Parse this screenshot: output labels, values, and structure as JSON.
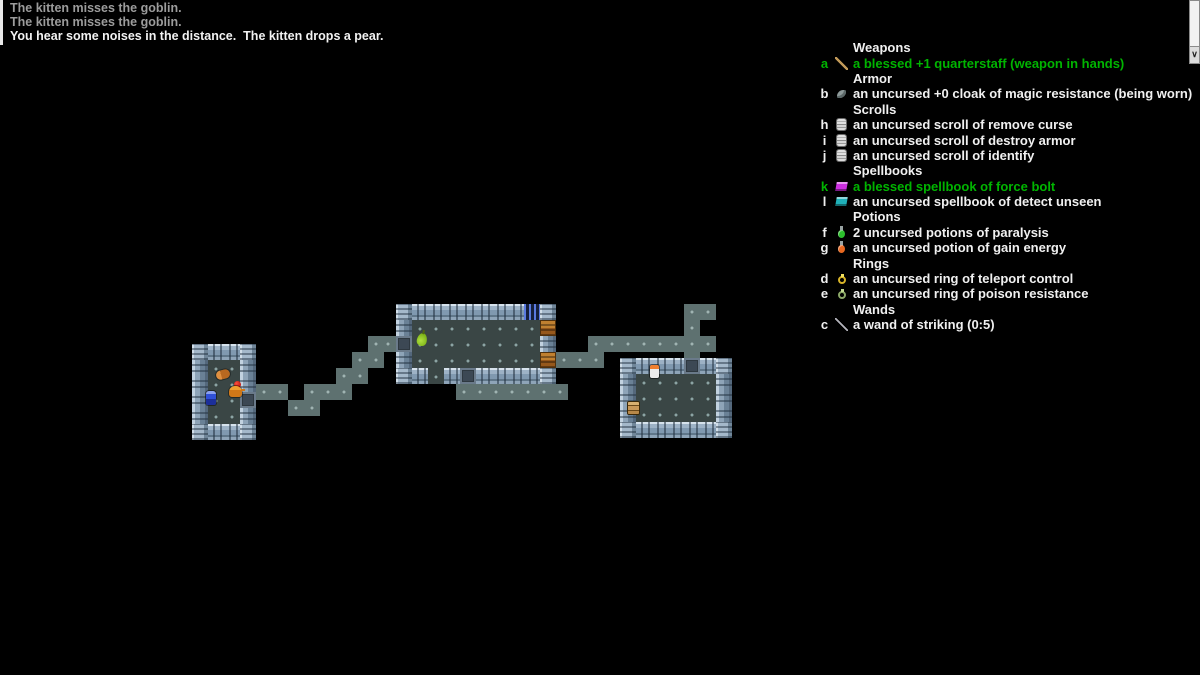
{
  "messages": [
    {
      "text": "The kitten misses the goblin.",
      "state": "old"
    },
    {
      "text": "The kitten misses the goblin.",
      "state": "old"
    },
    {
      "text": "You hear some noises in the distance.  The kitten drops a pear.",
      "state": "new"
    }
  ],
  "scrollbar": {
    "down_arrow": "∨"
  },
  "colors": {
    "blessed_green": "#00b400",
    "old_message_gray": "#9c9c9c",
    "new_message_white": "#f2f2f2",
    "floor": "#3a4645",
    "corridor": "#5e7170",
    "wall": "#9db2c6",
    "open_door_orange": "#c08030",
    "iron_bars_blue": "#5a7ae0"
  },
  "inventory": {
    "sections": [
      {
        "header": "Weapons",
        "items": [
          {
            "letter": "a",
            "icon": "quarterstaff",
            "text": "a blessed +1 quarterstaff (weapon in hands)",
            "blessed": true
          }
        ]
      },
      {
        "header": "Armor",
        "items": [
          {
            "letter": "b",
            "icon": "cloak",
            "text": "an uncursed +0 cloak of magic resistance (being worn)",
            "blessed": false
          }
        ]
      },
      {
        "header": "Scrolls",
        "items": [
          {
            "letter": "h",
            "icon": "scroll",
            "text": "an uncursed scroll of remove curse",
            "blessed": false
          },
          {
            "letter": "i",
            "icon": "scroll",
            "text": "an uncursed scroll of destroy armor",
            "blessed": false
          },
          {
            "letter": "j",
            "icon": "scroll",
            "text": "an uncursed scroll of identify",
            "blessed": false
          }
        ]
      },
      {
        "header": "Spellbooks",
        "items": [
          {
            "letter": "k",
            "icon": "book-magenta",
            "text": "a blessed spellbook of force bolt",
            "blessed": true
          },
          {
            "letter": "l",
            "icon": "book-cyan",
            "text": "an uncursed spellbook of detect unseen",
            "blessed": false
          }
        ]
      },
      {
        "header": "Potions",
        "items": [
          {
            "letter": "f",
            "icon": "potion-green",
            "text": "2 uncursed potions of paralysis",
            "blessed": false
          },
          {
            "letter": "g",
            "icon": "potion-orange",
            "text": "an uncursed potion of gain energy",
            "blessed": false
          }
        ]
      },
      {
        "header": "Rings",
        "items": [
          {
            "letter": "d",
            "icon": "ring-gold",
            "text": "an uncursed ring of teleport control",
            "blessed": false
          },
          {
            "letter": "e",
            "icon": "ring-green",
            "text": "an uncursed ring of poison resistance",
            "blessed": false
          }
        ]
      },
      {
        "header": "Wands",
        "items": [
          {
            "letter": "c",
            "icon": "wand",
            "text": "a wand of striking (0:5)",
            "blessed": false
          }
        ]
      }
    ]
  },
  "map": {
    "tile": 16,
    "rooms": [
      {
        "name": "left-room",
        "x": 192,
        "y": 344,
        "cols": 4,
        "rows": 6,
        "doors": [
          {
            "side": "right",
            "row": 3,
            "type": "door-gray"
          }
        ]
      },
      {
        "name": "middle-room",
        "x": 396,
        "y": 304,
        "cols": 10,
        "rows": 5,
        "doors": [
          {
            "side": "left",
            "row": 2,
            "type": "door-gray"
          },
          {
            "side": "right",
            "row": 1,
            "type": "door-open"
          },
          {
            "side": "right",
            "row": 3,
            "type": "door-open"
          },
          {
            "side": "top",
            "col": 8,
            "type": "bars"
          },
          {
            "side": "bottom",
            "col": 2,
            "type": "gap"
          },
          {
            "side": "bottom",
            "col": 4,
            "type": "door-gray"
          }
        ]
      },
      {
        "name": "right-room",
        "x": 620,
        "y": 358,
        "cols": 7,
        "rows": 5,
        "doors": [
          {
            "side": "top",
            "col": 4,
            "type": "door-gray"
          }
        ]
      }
    ],
    "corridors": [
      [
        256,
        384
      ],
      [
        272,
        384
      ],
      [
        288,
        400
      ],
      [
        304,
        400
      ],
      [
        304,
        384
      ],
      [
        320,
        384
      ],
      [
        336,
        384
      ],
      [
        336,
        368
      ],
      [
        352,
        368
      ],
      [
        352,
        352
      ],
      [
        368,
        352
      ],
      [
        368,
        336
      ],
      [
        380,
        336
      ],
      [
        456,
        384
      ],
      [
        472,
        384
      ],
      [
        488,
        384
      ],
      [
        504,
        384
      ],
      [
        520,
        384
      ],
      [
        536,
        384
      ],
      [
        552,
        384
      ],
      [
        556,
        352
      ],
      [
        572,
        352
      ],
      [
        588,
        352
      ],
      [
        588,
        336
      ],
      [
        604,
        336
      ],
      [
        620,
        336
      ],
      [
        636,
        336
      ],
      [
        652,
        336
      ],
      [
        668,
        336
      ],
      [
        684,
        336
      ],
      [
        700,
        336
      ],
      [
        684,
        320
      ],
      [
        684,
        304
      ],
      [
        700,
        304
      ],
      [
        684,
        352
      ]
    ],
    "sprites": [
      {
        "type": "goblin",
        "x": 216,
        "y": 370
      },
      {
        "type": "apple",
        "x": 234,
        "y": 381
      },
      {
        "type": "kitten",
        "x": 229,
        "y": 386
      },
      {
        "type": "player",
        "x": 206,
        "y": 391
      },
      {
        "type": "pear",
        "x": 417,
        "y": 333
      },
      {
        "type": "figure",
        "x": 650,
        "y": 365
      },
      {
        "type": "chest",
        "x": 628,
        "y": 402
      }
    ]
  }
}
